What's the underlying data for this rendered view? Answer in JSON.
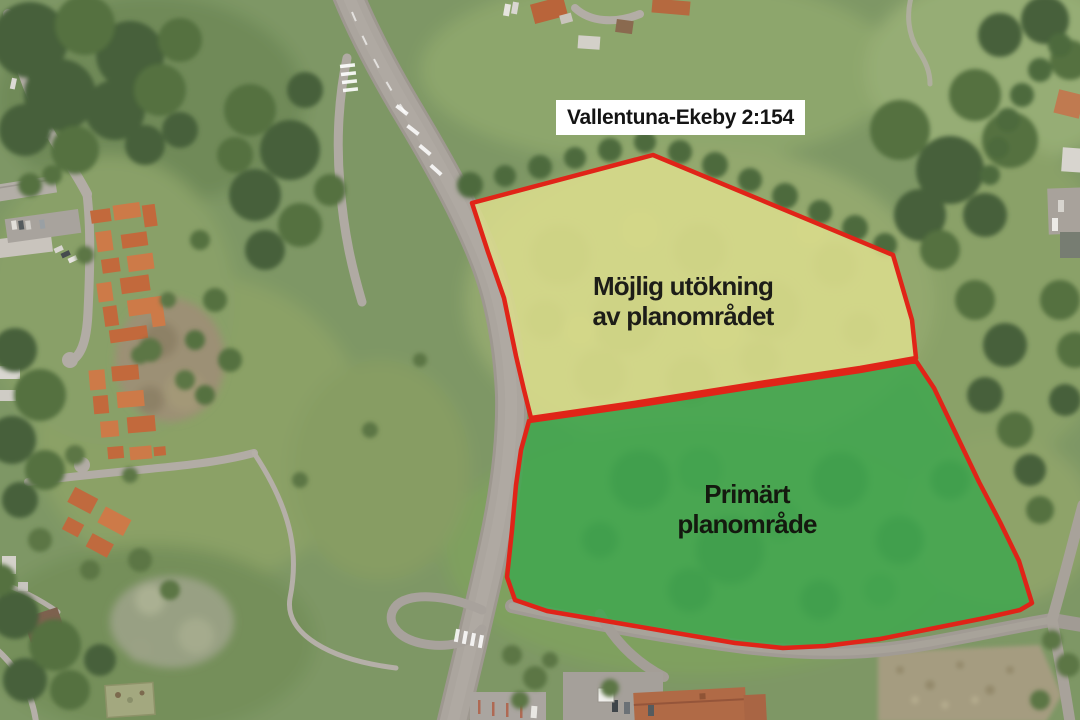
{
  "page": {
    "kind": "annotated-aerial-planning-map",
    "language": "sv"
  },
  "map": {
    "parcel_label": {
      "text": "Vallentuna-Ekeby 2:154",
      "background": "#ffffff",
      "text_color": "#141414"
    },
    "areas": {
      "expansion": {
        "label_line1": "Möjlig utökning",
        "label_line2": "av planområdet",
        "fill_color": "#d9dc8c",
        "border_color": "#e02418",
        "text_color": "#1d1d18"
      },
      "primary": {
        "label_line1": "Primärt",
        "label_line2": "planområde",
        "fill_color": "#3fa74f",
        "border_color": "#e02418",
        "text_color": "#14190f"
      }
    }
  }
}
